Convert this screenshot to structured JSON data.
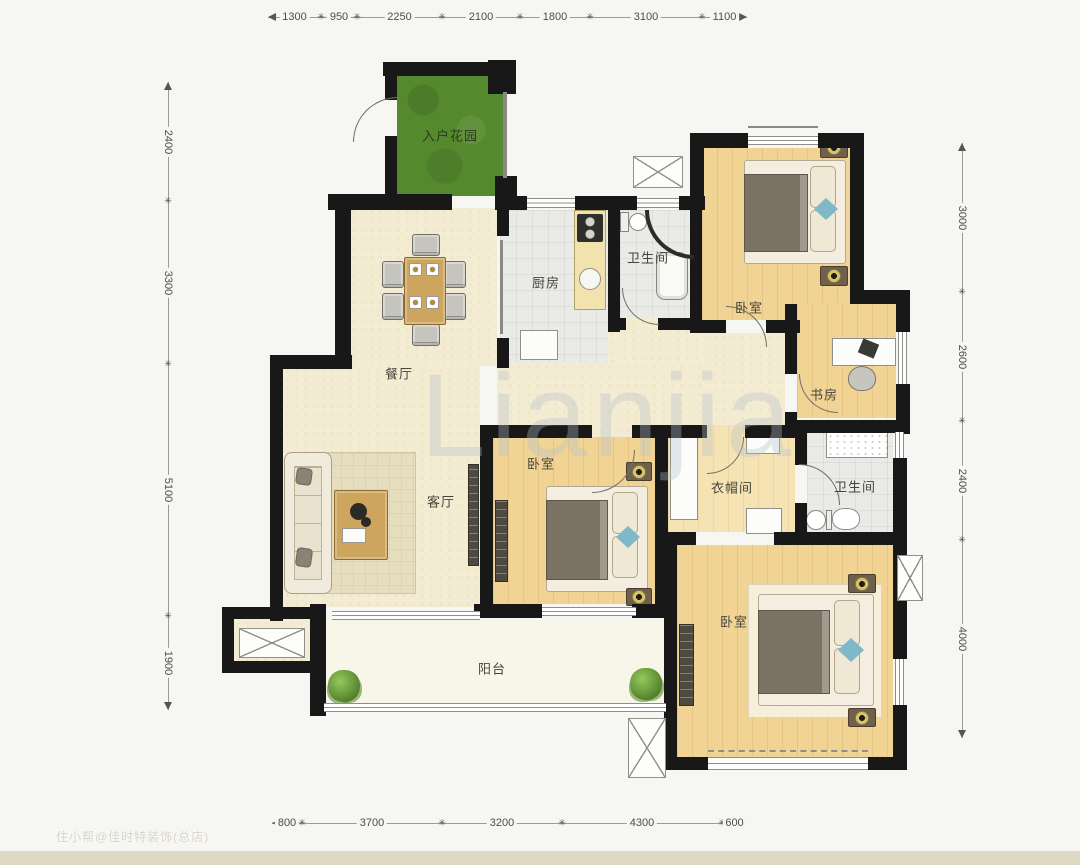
{
  "rooms": {
    "entry_garden": "入户花园",
    "kitchen": "厨房",
    "bath1": "卫生间",
    "bedroom1": "卧室",
    "study": "书房",
    "dining": "餐厅",
    "living": "客厅",
    "bedroom2": "卧室",
    "cloakroom": "衣帽间",
    "bath2": "卫生间",
    "bedroom3": "卧室",
    "balcony": "阳台"
  },
  "dimensions": {
    "top": [
      "1300",
      "950",
      "2250",
      "2100",
      "1800",
      "3100",
      "1100"
    ],
    "bottom": [
      "800",
      "3700",
      "3200",
      "4300",
      "600"
    ],
    "left": [
      "2400",
      "3300",
      "5100",
      "1900"
    ],
    "right": [
      "3000",
      "2600",
      "2400",
      "4000"
    ]
  },
  "watermarks": {
    "center": "Lianjia",
    "corner": "住小帮@佳时特装饰(总店)"
  },
  "colors": {
    "wall": "#181818",
    "cream_floor": "#f4ecd2",
    "wood_floor": "#f1d494",
    "tile_floor": "#eaeae6",
    "garden_green": "#55892e",
    "balcony_floor": "#f8f5e9",
    "teal_accent": "#7fb8c6"
  }
}
